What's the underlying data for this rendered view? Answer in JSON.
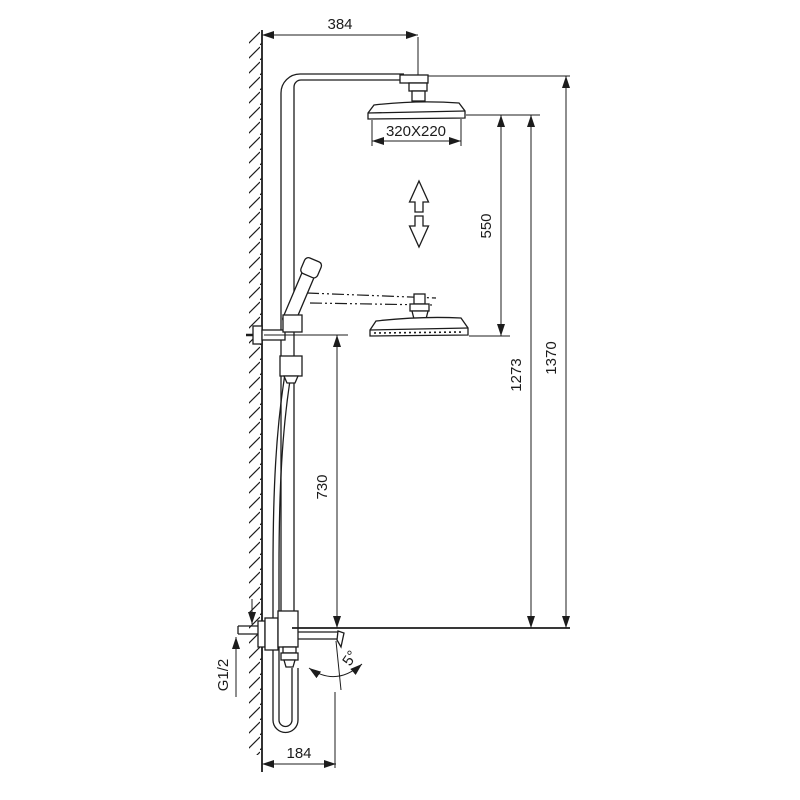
{
  "labels": {
    "arm_reach": "384",
    "head_size": "320X220",
    "height_adjust": "550",
    "lower_head_height": "1273",
    "total_height": "1370",
    "bracket_height": "730",
    "inlet_thread": "G1/2",
    "spout_reach": "184",
    "spout_angle": "5°"
  }
}
